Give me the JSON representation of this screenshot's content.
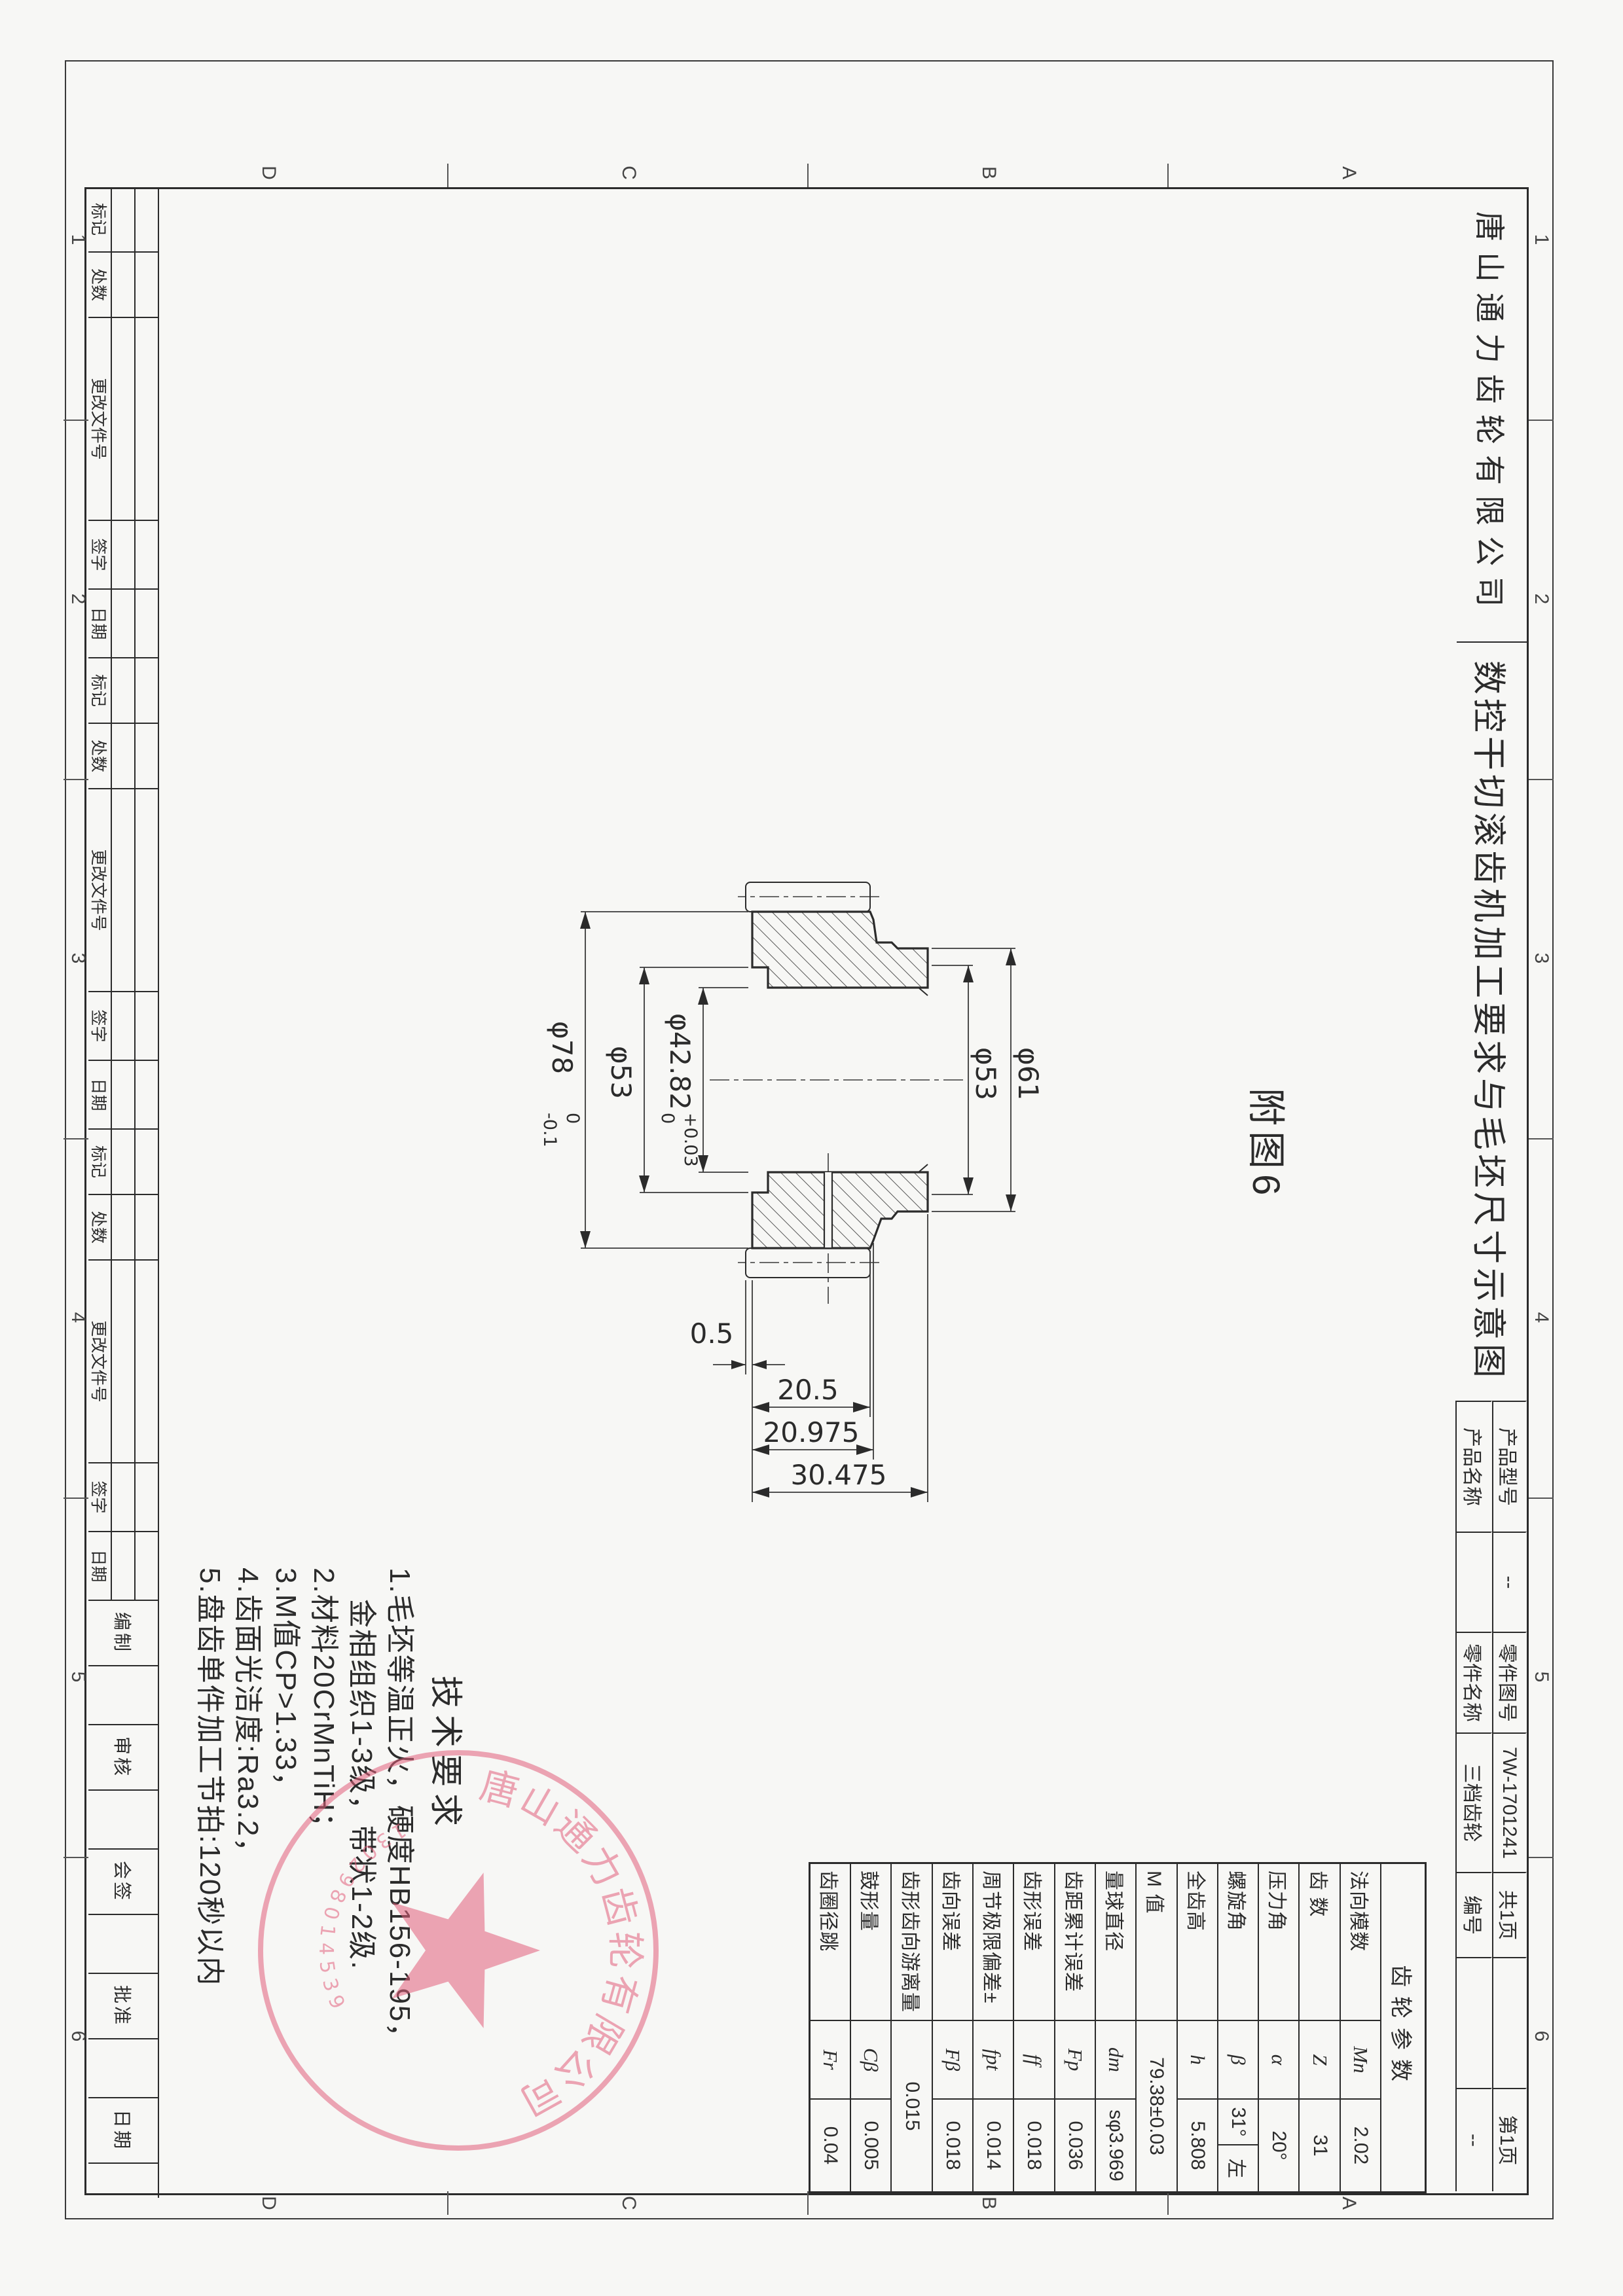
{
  "title_bar": {
    "company": "唐山通力齿轮有限公司",
    "title": "数控干切滚齿机加工要求与毛坯尺寸示意图",
    "block": {
      "r1c1": "产品型号",
      "r1c2": "--",
      "r1c3": "零件图号",
      "r1c4": "7W-1701241",
      "r1c5": "共1页",
      "r1c7": "第1页",
      "r2c1": "产品名称",
      "r2c2": "",
      "r2c3": "零件名称",
      "r2c4": "三档齿轮",
      "r2c5": "编号",
      "r2c7": "--"
    }
  },
  "figure_label": "附图6",
  "zones": {
    "cols": [
      "1",
      "2",
      "3",
      "4",
      "5",
      "6"
    ],
    "rows": [
      "A",
      "B",
      "C",
      "D"
    ]
  },
  "revision": {
    "labels": [
      "标记",
      "处数",
      "更改文件号",
      "签字",
      "日期"
    ],
    "signature_labels": [
      "编制",
      "审核",
      "会签",
      "批准",
      "日期"
    ]
  },
  "params": {
    "header": "齿轮参数",
    "rows": [
      {
        "label": "法向模数",
        "sym": "Mn",
        "value": "2.02"
      },
      {
        "label": "齿  数",
        "sym": "Z",
        "value": "31"
      },
      {
        "label": "压力角",
        "sym": "α",
        "value": "20°"
      },
      {
        "label": "螺旋角",
        "sym": "β",
        "value": "31°",
        "value2": "左"
      },
      {
        "label": "全齿高",
        "sym": "h",
        "value": "5.808"
      },
      {
        "label": "M 值",
        "sym": "",
        "value": "79.38±0.03"
      },
      {
        "label": "量球直径",
        "sym": "dm",
        "value": "sφ3.969"
      },
      {
        "label": "齿距累计误差",
        "sym": "Fp",
        "value": "0.036"
      },
      {
        "label": "齿形误差",
        "sym": "ff",
        "value": "0.018"
      },
      {
        "label": "周节极限偏差±",
        "sym": "fpt",
        "value": "0.014"
      },
      {
        "label": "齿向误差",
        "sym": "Fβ",
        "value": "0.018"
      },
      {
        "label": "齿形齿向游离量",
        "sym": "",
        "value": "0.015"
      },
      {
        "label": "鼓形量",
        "sym": "Cβ",
        "value": "0.005"
      },
      {
        "label": "齿圈径跳",
        "sym": "Fr",
        "value": "0.04"
      }
    ]
  },
  "tech": {
    "title": "技术要求",
    "lines": [
      "1.毛坯等温正火，硬度HB156-195，",
      "金相组织1-3级，带状1-2级.",
      "2.材料20CrMnTiH；",
      "3.M值CP>1.33，",
      "4.齿面光洁度:Ra3.2，",
      "5.盘齿单件加工节拍:120秒以内"
    ]
  },
  "dims": {
    "bore": "φ42.82",
    "bore_up": "+0.03",
    "bore_dn": "0",
    "web": "φ53",
    "od": "φ78",
    "od_up": "0",
    "od_dn": "-0.1",
    "step": "φ53",
    "flange": "φ61",
    "gap": "0.5",
    "teeth_w": "20.5",
    "rim_w": "20.975",
    "total_w": "30.475"
  },
  "stamp": {
    "arc_text": "唐山通力齿轮有限公司",
    "number": "130298014539"
  }
}
